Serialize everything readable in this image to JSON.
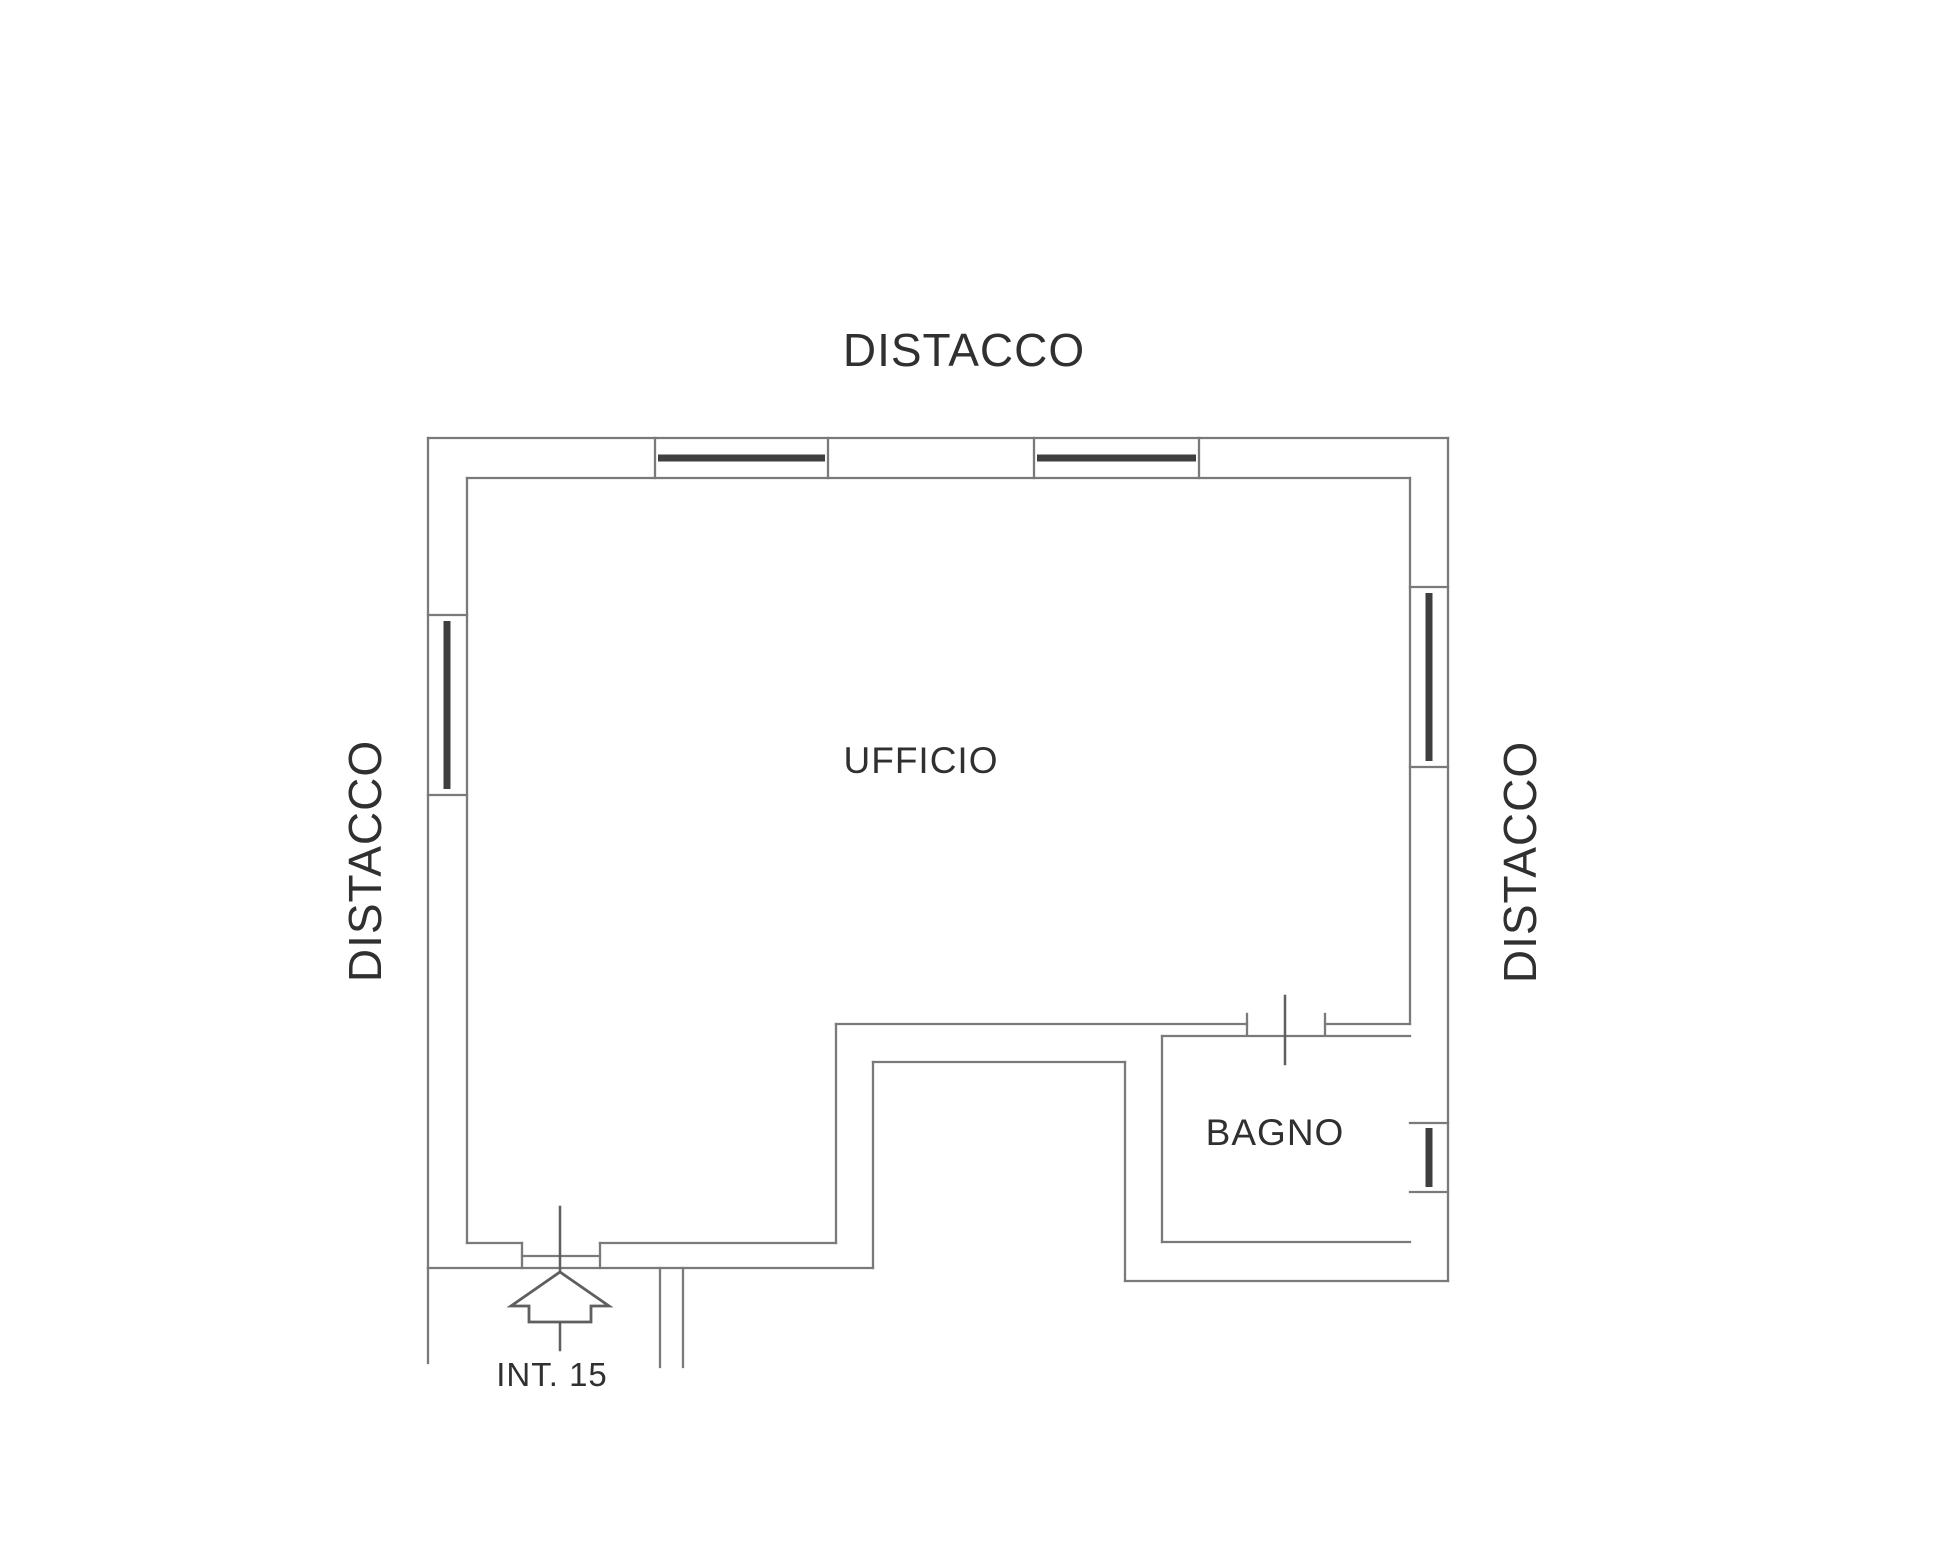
{
  "plan": {
    "surroundings_labels": {
      "top": "DISTACCO",
      "left": "DISTACCO",
      "right": "DISTACCO"
    },
    "rooms": [
      {
        "name": "UFFICIO"
      },
      {
        "name": "BAGNO"
      }
    ],
    "unit_label": "INT. 15"
  },
  "colors": {
    "background": "#ffffff",
    "wall_line": "#7a7a7a",
    "window_bar": "#3f3f3f",
    "symbol_line": "#5f5f5f",
    "text": "#303030"
  }
}
